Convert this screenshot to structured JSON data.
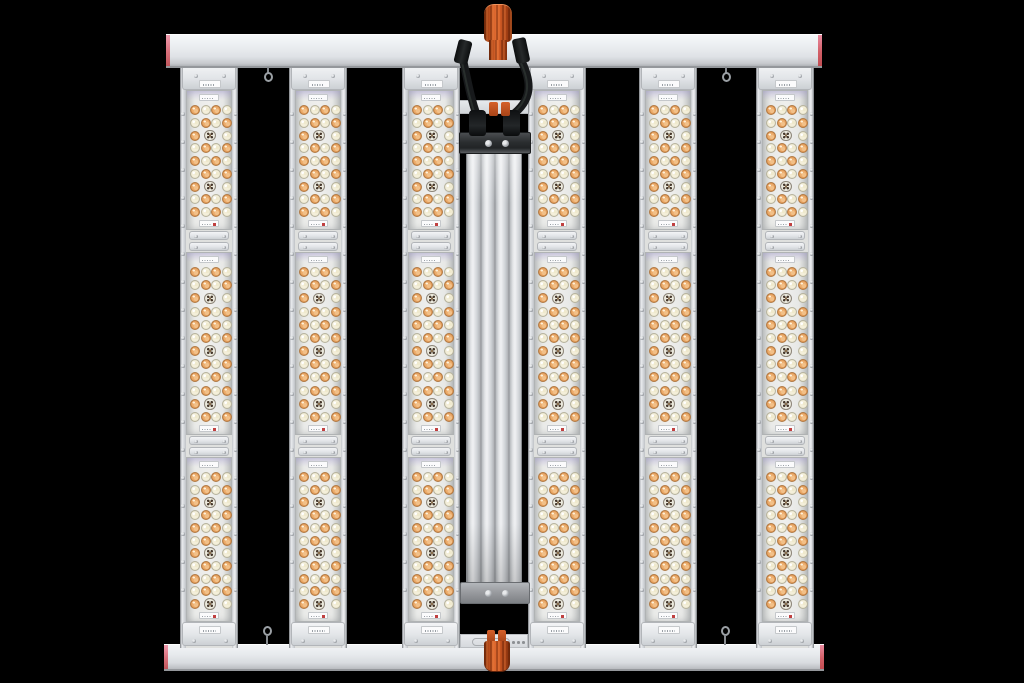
{
  "scene": {
    "type": "product-photo",
    "description": "Six-bar full-spectrum LED grow light fixture with center-mounted power driver, viewed face-on against a black background",
    "background_color": "#000000"
  },
  "frame": {
    "top_bar": {
      "x": 166,
      "y": 34,
      "width": 656,
      "height": 34
    },
    "bottom_bar": {
      "x": 164,
      "y": 644,
      "width": 660,
      "height": 27
    },
    "surface_color": "#e9ecef",
    "end_cap_colors": [
      "#e77f95",
      "#cf4b4f"
    ]
  },
  "clips": {
    "count": 2,
    "color": "#cf5a24",
    "top": {
      "cx": 498,
      "body": [
        484,
        4,
        28,
        38
      ],
      "neck": [
        489,
        40,
        18,
        20
      ],
      "prongs": [
        [
          489,
          102,
          9,
          14
        ],
        [
          501,
          102,
          9,
          14
        ]
      ]
    },
    "bottom": {
      "cx": 497,
      "body": [
        484,
        641,
        26,
        31
      ],
      "prongs": [
        [
          487,
          630,
          8,
          12
        ],
        [
          498,
          630,
          8,
          12
        ]
      ]
    }
  },
  "hooks": {
    "color": "#9ba0a5",
    "top_x": [
      268,
      726
    ],
    "bottom_x": [
      267,
      725
    ]
  },
  "bars": {
    "count": 6,
    "left_edges": [
      180,
      289,
      402,
      528,
      639,
      756
    ],
    "width": 58,
    "top": 60,
    "bottom": 648,
    "rail_color": "#d6d9dd",
    "lens_color": "#ebecea",
    "segments": [
      {
        "lens_top": 90,
        "lens_bottom": 230,
        "rows": 9,
        "special_rows": [
          2,
          6
        ]
      },
      {
        "lens_top": 252,
        "lens_bottom": 435,
        "rows": 12,
        "special_rows": [
          2,
          6,
          10
        ]
      },
      {
        "lens_top": 457,
        "lens_bottom": 622,
        "rows": 11,
        "special_rows": [
          2,
          6,
          10
        ]
      }
    ],
    "junctions": [
      231,
      436
    ],
    "led": {
      "columns": 4,
      "diameter": 10,
      "special_diameter": 11.5,
      "column_centers": [
        8,
        18.7,
        29.3,
        40
      ],
      "colors": {
        "amber": "#e8a55e",
        "warm_white": "#f3eeda",
        "special_dark": "#46382c"
      }
    }
  },
  "driver": {
    "mount_strip_top": {
      "x": 458,
      "y": 100,
      "width": 72,
      "height": 14
    },
    "mount_plate_bottom": {
      "x": 460,
      "y": 634,
      "width": 68,
      "height": 14
    },
    "bracket_top": {
      "x": 459,
      "y": 132,
      "width": 72,
      "height": 22,
      "color": "#2b2e30"
    },
    "body": {
      "x": 466,
      "y": 152,
      "width": 56,
      "height": 432,
      "color": "#d0d3d7"
    },
    "bracket_bottom": {
      "x": 460,
      "y": 582,
      "width": 70,
      "height": 22,
      "color": "#97999d"
    },
    "bracket_screws": {
      "top": [
        [
          487,
          143
        ],
        [
          504,
          143
        ]
      ],
      "bottom": [
        [
          487,
          593
        ],
        [
          504,
          593
        ]
      ]
    },
    "plugs": [
      [
        469,
        110,
        17,
        26
      ],
      [
        503,
        110,
        17,
        26
      ]
    ],
    "connector_blocks": [
      [
        456,
        40,
        14,
        24,
        14
      ],
      [
        514,
        38,
        14,
        25,
        -12
      ]
    ],
    "cable_color": "#17191b",
    "cables": [
      {
        "path": "M33,32 C38,54 40,68 47,88"
      },
      {
        "path": "M91,32 C102,54 103,72 81,88"
      }
    ],
    "cable_svg_origin": [
      430,
      28
    ],
    "cable_svg_size": [
      130,
      104
    ]
  }
}
